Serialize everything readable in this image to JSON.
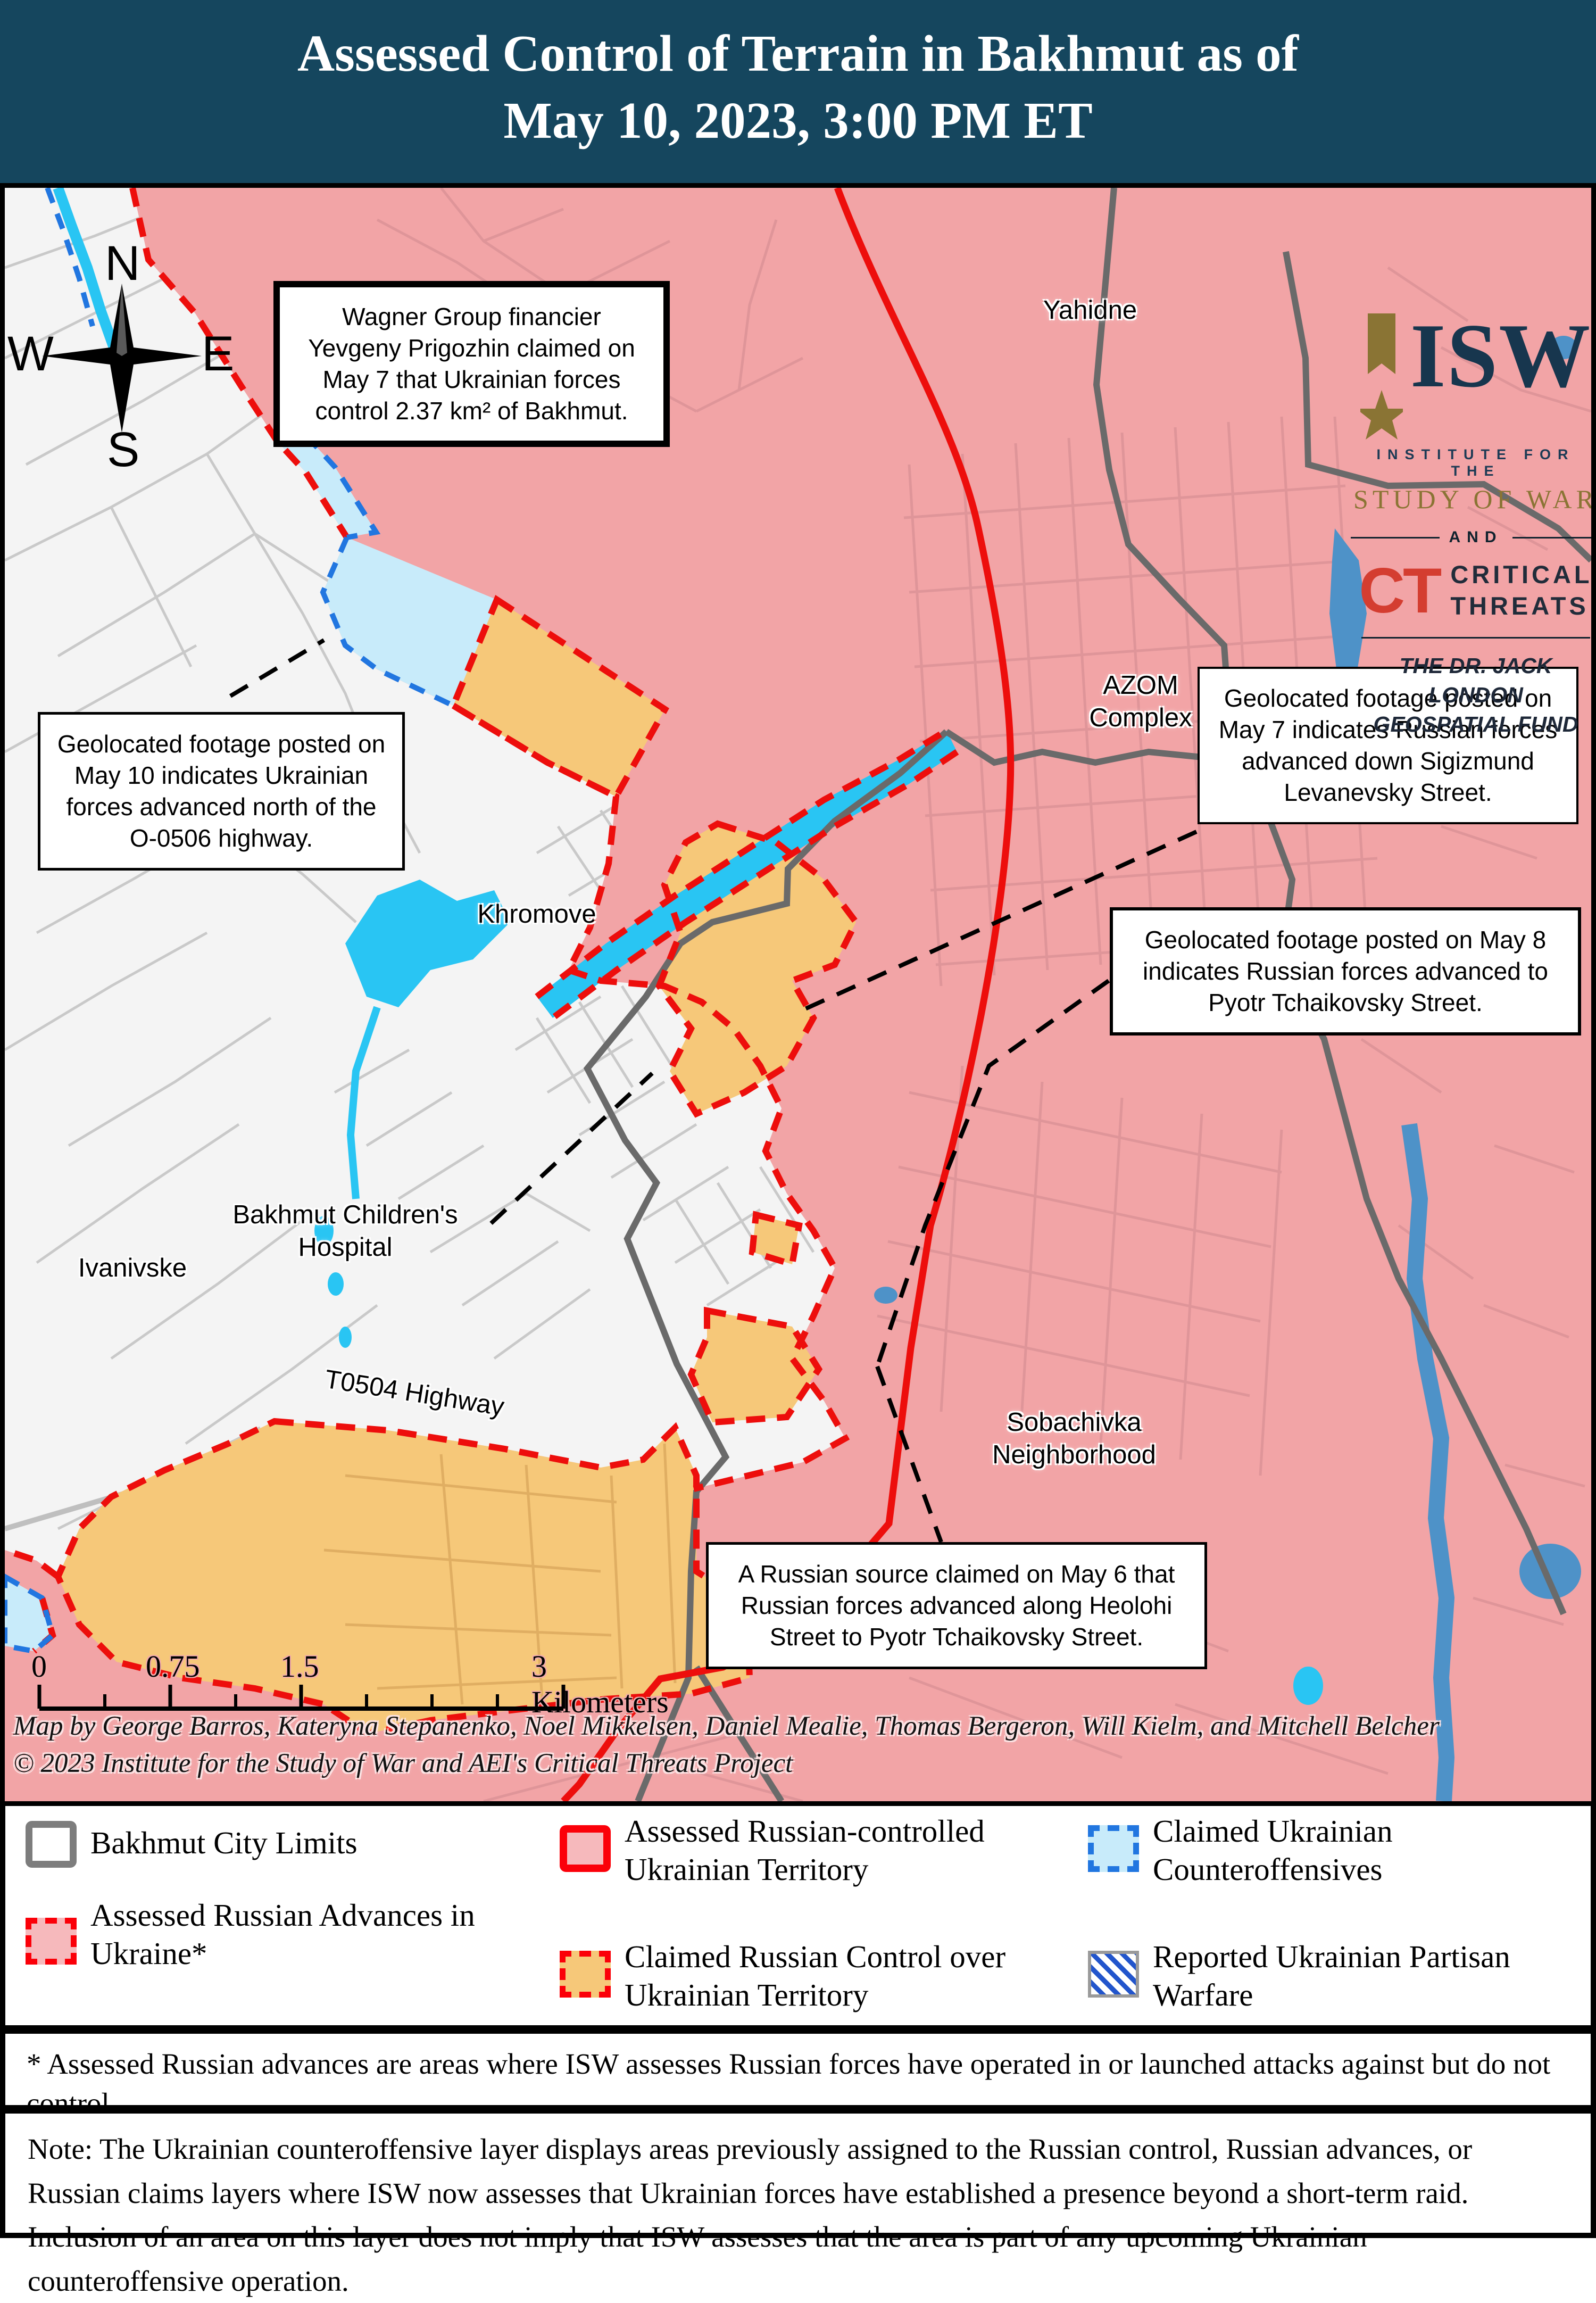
{
  "title": {
    "line1": "Assessed Control of Terrain in Bakhmut as of",
    "line2": "May 10, 2023, 3:00 PM ET"
  },
  "compass": {
    "north": "N",
    "south": "S",
    "east": "E",
    "west": "W"
  },
  "map_labels": {
    "yahidne": "Yahidne",
    "azom": "AZOM\nComplex",
    "khromove": "Khromove",
    "childrens_hospital": "Bakhmut Children's\nHospital",
    "ivanivske": "Ivanivske",
    "t0504": "T0504 Highway",
    "sobachivka": "Sobachivka\nNeighborhood"
  },
  "callouts": {
    "wagner": "Wagner Group financier Yevgeny Prigozhin claimed on May 7 that Ukrainian forces control 2.37 km² of Bakhmut.",
    "may10": "Geolocated footage posted on May 10 indicates Ukrainian forces advanced north of the O-0506 highway.",
    "may7": "Geolocated footage posted on May 7 indicates Russian forces advanced down Sigizmund Levanevsky Street.",
    "may8": "Geolocated footage posted on May 8 indicates Russian forces advanced to Pyotr Tchaikovsky Street.",
    "may6": "A Russian source claimed on May 6 that Russian forces advanced along Heolohi Street to Pyotr Tchaikovsky Street."
  },
  "logo": {
    "isw": "ISW",
    "institute": "INSTITUTE FOR THE",
    "study": "STUDY OF WAR",
    "and": "AND",
    "ct": "CT",
    "critical_threats": "CRITICAL\nTHREATS",
    "fund": "THE DR. JACK LONDON\nGEOSPATIAL FUND"
  },
  "scale_bar": {
    "t0": "0",
    "t1": "0.75",
    "t2": "1.5",
    "t3": "3 Kilometers"
  },
  "attribution": {
    "line1": "Map by George Barros, Kateryna Stepanenko, Noel Mikkelsen, Daniel Mealie, Thomas Bergeron, Will Kielm, and Mitchell Belcher",
    "line2": "© 2023 Institute for the Study of War and AEI's Critical Threats Project"
  },
  "legend": {
    "city_limits": "Bakhmut City Limits",
    "advances": "Assessed Russian Advances in\nUkraine*",
    "controlled": "Assessed Russian-controlled\nUkrainian Territory",
    "claimed": "Claimed Russian Control over\nUkrainian Territory",
    "counteroffensives": "Claimed Ukrainian\nCounteroffensives",
    "partisan": "Reported Ukrainian Partisan\nWarfare"
  },
  "footnote": "* Assessed Russian advances are areas where ISW assesses Russian forces have operated in or launched attacks against but do not control.",
  "note": "Note: The Ukrainian counteroffensive layer displays areas previously assigned to the Russian control, Russian advances, or Russian claims layers where ISW now assesses that Ukrainian forces have established a presence beyond a short-term raid. Inclusion of an area on this layer does not imply that ISW assesses that the area is part of any upcoming Ukrainian counteroffensive operation.",
  "colors": {
    "header_navy": "#15465e",
    "russian_controlled_pink": "#f2a4a6",
    "claimed_russian_orange": "#f6c879",
    "counteroffensive_blue": "#c8ebfa",
    "water_cyan": "#29c5f3",
    "river_steel_blue": "#4e92c8",
    "front_line_red": "#ed0e0c",
    "city_limits_gray": "#6a6a6a",
    "partisan_stripe_blue": "#2255cc"
  }
}
